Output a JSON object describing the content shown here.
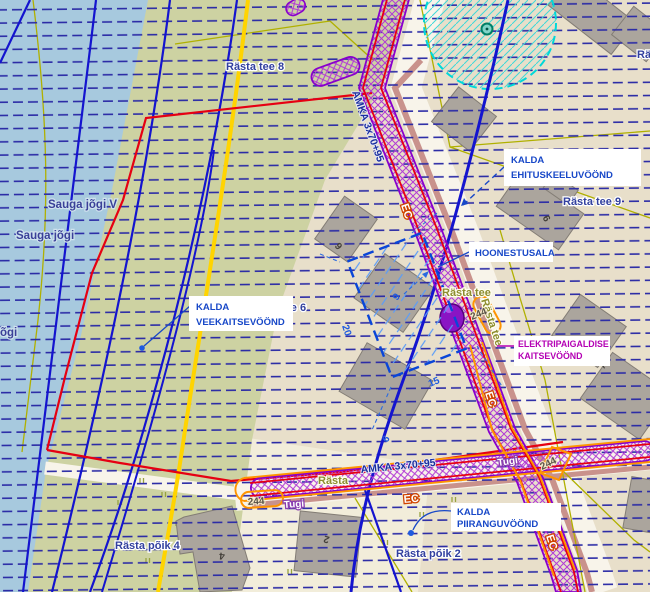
{
  "annotations": {
    "ehituskeeluvoond": {
      "line1": "KALDA",
      "line2": "EHITUSKEELUVÖÖND"
    },
    "hoonestusala": {
      "label": "HOONESTUSALA"
    },
    "veekaitsevoond": {
      "line1": "KALDA",
      "line2": "VEEKAITSEVÖÖND"
    },
    "elektripaigaldise_kaitsevoond": {
      "line1": "ELEKTRIPAIGALDISE",
      "line2": "KAITSEVÖÖND"
    },
    "piiranguvoond": {
      "line1": "KALDA",
      "line2": "PIIRANGUVÖÖND"
    }
  },
  "streets": {
    "rasta_tee_8": "Rästa tee 8",
    "rasta_tee_9": "Rästa tee 9",
    "rasta_tee_6": "Rästa tee 6",
    "rasta_poik_4": "Rästa põik 4",
    "rasta_poik_2": "Rästa põik 2",
    "rasta_tee_a": "Rästa tee",
    "rasta_tee_b": "Rästa tee",
    "rasta_partial": "Rästa",
    "ra_partial": "Rä"
  },
  "water": {
    "sauga_jogi": "Sauga jõgi",
    "sauga_jogi_v": "Sauga jõgi V",
    "jogi_partial": "õgi"
  },
  "utilities": {
    "cable_diagonal": "AMKA 3x70+95",
    "cable_bottom": "AMKA 3x70+95",
    "ec_1": "EC",
    "ec_2": "EC",
    "ec_3": "EC",
    "ec_4": "EC",
    "tugi_1": "Tugi",
    "tugi_2": "Tugi",
    "pole_244_1": "244",
    "pole_244_2": "244",
    "pole_244_3": "244"
  },
  "dimensions": {
    "width": "20",
    "length": "15",
    "offset": "9",
    "gap": "6"
  },
  "building_numbers": {
    "n4": "4",
    "n2": "2",
    "n9": "9",
    "n7": "7",
    "n6": "6"
  },
  "colors": {
    "ground": "#e8dfca",
    "water": "#a7c9de",
    "land": "#cdd2a2",
    "field": "#f2edda",
    "zone_hatch": "#2b2ba6",
    "zone_line": "#1414cf",
    "boundary_red": "#e60012",
    "road_yellow": "#ffd400",
    "cadastral_olive": "#b0b000",
    "corridor_purple": "#8800cc",
    "corridor_hatch": "#b23ad6",
    "warning_orange": "#ff9400",
    "label_navy": "#32409f",
    "label_olive": "#8d8d2f",
    "annotation_blue": "#1848c8",
    "annotation_magenta": "#b400b4",
    "circle_cyan": "#00d8d8",
    "building_gray": "#aba59d",
    "road_stripe": "#c9928c"
  }
}
